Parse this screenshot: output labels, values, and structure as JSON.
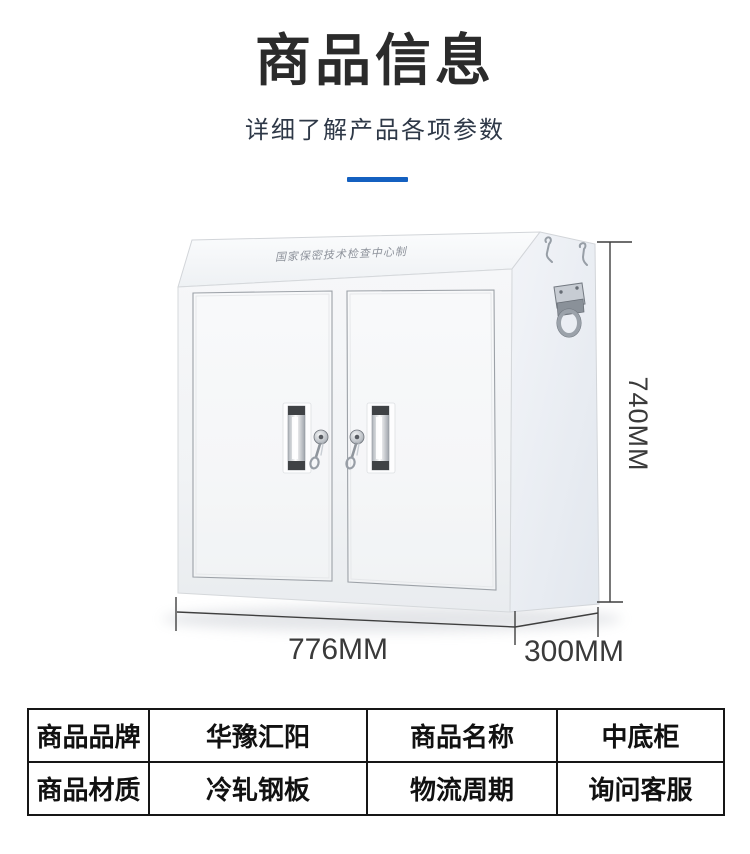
{
  "header": {
    "title": "商品信息",
    "subtitle": "详细了解产品各项参数"
  },
  "accent": {
    "divider_color": "#1460c0"
  },
  "product_figure": {
    "cabinet_top_text": "国家保密技术检查中心制",
    "dim_height": "740MM",
    "dim_width": "776MM",
    "dim_depth": "300MM"
  },
  "spec_table": {
    "rows": [
      {
        "cells": [
          "商品品牌",
          "华豫汇阳",
          "商品名称",
          "中底柜"
        ]
      },
      {
        "cells": [
          "商品材质",
          "冷轧钢板",
          "物流周期",
          "询问客服"
        ]
      }
    ]
  }
}
